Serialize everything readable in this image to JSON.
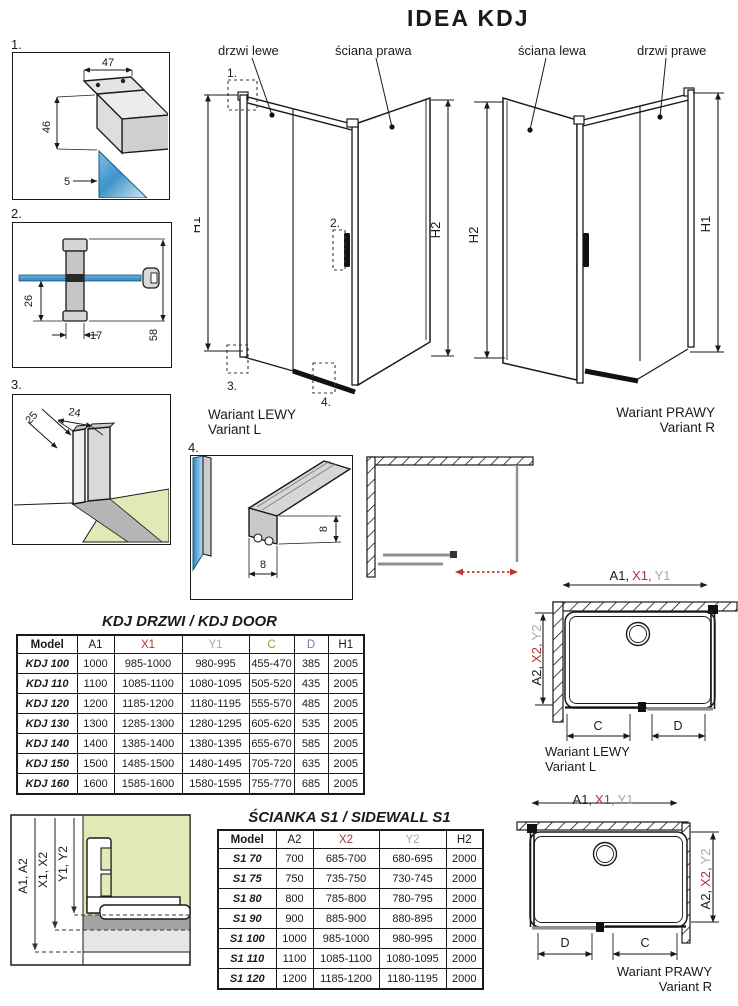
{
  "page": {
    "title": "IDEA KDJ"
  },
  "colors": {
    "red": "#b03434",
    "gray": "#a9a9a9",
    "green": "#8da33e",
    "purple": "#916fa5",
    "glass_blue": "#3f93c9",
    "floor_green": "#e1eab6",
    "door_gray": "#8f8f8f",
    "arrow_red": "#c03a2e",
    "line_black": "#1a1a1a"
  },
  "details": {
    "d1": {
      "label": "1.",
      "dim_top": "47",
      "dim_left": "46",
      "dim_bottom": "5"
    },
    "d2": {
      "label": "2.",
      "dim_left": "26",
      "dim_bottom": "17",
      "dim_right": "58"
    },
    "d3": {
      "label": "3.",
      "dim_diag": "25",
      "dim_top": "24"
    },
    "d4": {
      "label": "4.",
      "dim_right": "8",
      "dim_bottom": "8"
    }
  },
  "variant_left": {
    "door_label": "drzwi lewe",
    "wall_label": "ściana prawa",
    "h1": "H1",
    "h2": "H2",
    "m1": "1.",
    "m2": "2.",
    "m3": "3.",
    "m4": "4.",
    "caption_pl": "Wariant LEWY",
    "caption_en": "Variant L"
  },
  "variant_right": {
    "wall_label": "ściana lewa",
    "door_label": "drzwi prawe",
    "h1": "H1",
    "h2": "H2",
    "caption_pl": "Wariant PRAWY",
    "caption_en": "Variant R"
  },
  "door_table": {
    "title": "KDJ DRZWI / KDJ DOOR",
    "headers": [
      {
        "label": "Model",
        "color": "#1a1a1a"
      },
      {
        "label": "A1",
        "color": "#1a1a1a"
      },
      {
        "label": "X1",
        "color": "#b03434"
      },
      {
        "label": "Y1",
        "color": "#a9a9a9"
      },
      {
        "label": "C",
        "color": "#8da33e"
      },
      {
        "label": "D",
        "color": "#916fa5"
      },
      {
        "label": "H1",
        "color": "#1a1a1a"
      }
    ],
    "rows": [
      [
        "KDJ 100",
        "1000",
        "985-1000",
        "980-995",
        "455-470",
        "385",
        "2005"
      ],
      [
        "KDJ 110",
        "1100",
        "1085-1100",
        "1080-1095",
        "505-520",
        "435",
        "2005"
      ],
      [
        "KDJ 120",
        "1200",
        "1185-1200",
        "1180-1195",
        "555-570",
        "485",
        "2005"
      ],
      [
        "KDJ 130",
        "1300",
        "1285-1300",
        "1280-1295",
        "605-620",
        "535",
        "2005"
      ],
      [
        "KDJ 140",
        "1400",
        "1385-1400",
        "1380-1395",
        "655-670",
        "585",
        "2005"
      ],
      [
        "KDJ 150",
        "1500",
        "1485-1500",
        "1480-1495",
        "705-720",
        "635",
        "2005"
      ],
      [
        "KDJ 160",
        "1600",
        "1585-1600",
        "1580-1595",
        "755-770",
        "685",
        "2005"
      ]
    ]
  },
  "sidewall_table": {
    "title": "ŚCIANKA S1 / SIDEWALL S1",
    "headers": [
      {
        "label": "Model",
        "color": "#1a1a1a"
      },
      {
        "label": "A2",
        "color": "#1a1a1a"
      },
      {
        "label": "X2",
        "color": "#b03434"
      },
      {
        "label": "Y2",
        "color": "#a9a9a9"
      },
      {
        "label": "H2",
        "color": "#1a1a1a"
      }
    ],
    "rows": [
      [
        "S1 70",
        "700",
        "685-700",
        "680-695",
        "2000"
      ],
      [
        "S1 75",
        "750",
        "735-750",
        "730-745",
        "2000"
      ],
      [
        "S1 80",
        "800",
        "785-800",
        "780-795",
        "2000"
      ],
      [
        "S1 90",
        "900",
        "885-900",
        "880-895",
        "2000"
      ],
      [
        "S1 100",
        "1000",
        "985-1000",
        "980-995",
        "2000"
      ],
      [
        "S1 110",
        "1100",
        "1085-1100",
        "1080-1095",
        "2000"
      ],
      [
        "S1 120",
        "1200",
        "1185-1200",
        "1180-1195",
        "2000"
      ]
    ]
  },
  "plan_left": {
    "a1": "A1,",
    "x1": "X1,",
    "y1": "Y1",
    "a2": "A2,",
    "x2": "X2,",
    "y2": "Y2",
    "c": "C",
    "d": "D",
    "caption_pl": "Wariant LEWY",
    "caption_en": "Variant L"
  },
  "plan_right": {
    "a1": "A1,",
    "x1": "X1,",
    "y1": "Y1",
    "a2": "A2,",
    "x2": "X2,",
    "y2": "Y2",
    "c": "C",
    "d": "D",
    "caption_pl": "Wariant PRAWY",
    "caption_en": "Variant R"
  },
  "wall_section": {
    "a": "A1, A2",
    "x": "X1, X2",
    "y": "Y1, Y2"
  }
}
